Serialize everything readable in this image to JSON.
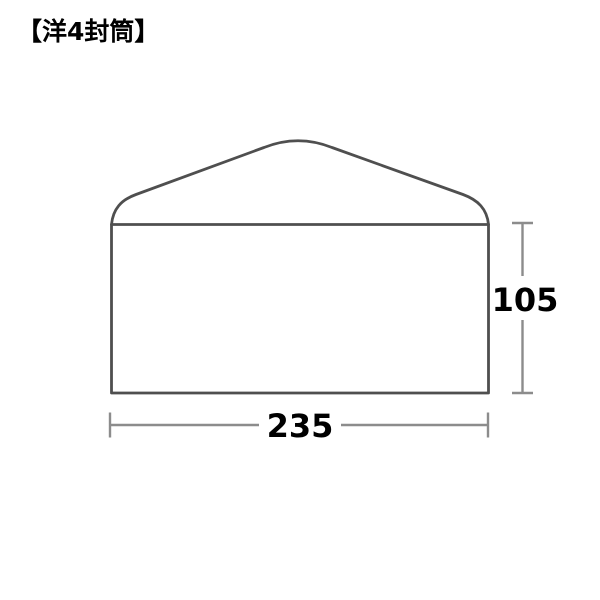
{
  "title": "【洋4封筒】",
  "diagram": {
    "label": "洋4封筒",
    "width_label": "235",
    "height_label": "105",
    "colors": {
      "envelope_outline": "#4f4f4f",
      "dimension_line": "#8c8c8c",
      "dimension_text": "#000000",
      "background": "#ffffff"
    }
  }
}
